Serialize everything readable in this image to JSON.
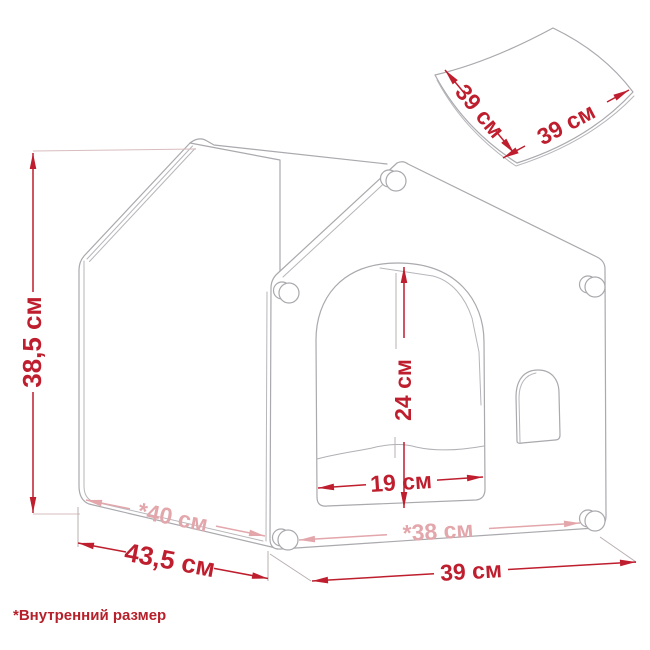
{
  "note": "*Внутренний размер",
  "dims": {
    "overall_height": "38,5 см",
    "base_depth": "43,5 см",
    "inner_depth": "*40 см",
    "inner_width": "*38 см",
    "base_width": "39 см",
    "door_width": "19 см",
    "door_height": "24 см",
    "cushion_side_a": "39 см",
    "cushion_side_b": "39 см"
  },
  "colors": {
    "dimension_red": "#be1e2d",
    "dimension_inner_pink": "#e2a6ab",
    "outline_gray": "#a9a9ae"
  }
}
